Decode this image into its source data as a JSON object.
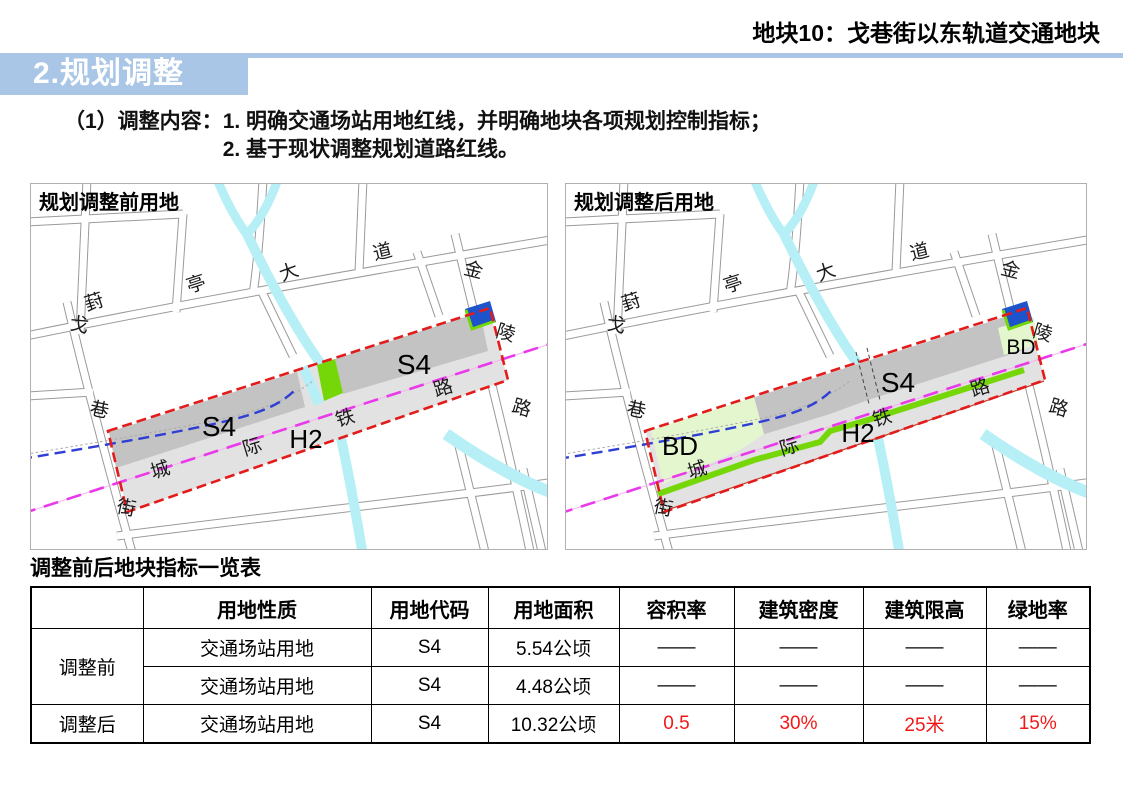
{
  "header": {
    "plot_tag": "地块10：戈巷街以东轨道交通地块"
  },
  "section": {
    "title": "2.规划调整"
  },
  "content": {
    "label": "（1）调整内容：",
    "items": [
      "1. 明确交通场站用地红线，并明确地块各项规划控制指标；",
      "2. 基于现状调整规划道路红线。"
    ]
  },
  "maps": {
    "before": {
      "title": "规划调整前用地",
      "s4_left": "S4",
      "s4_right": "S4",
      "h2": "H2"
    },
    "after": {
      "title": "规划调整后用地",
      "s4": "S4",
      "h2": "H2",
      "bd_left": "BD",
      "bd_right": "BD"
    },
    "streets": {
      "fengting": [
        "葑",
        "亭",
        "大",
        "道"
      ],
      "gexiang": [
        "戈",
        "巷",
        "街"
      ],
      "jinling": [
        "金",
        "陵",
        "路"
      ],
      "railway": [
        "城",
        "际",
        "铁",
        "路"
      ]
    }
  },
  "table": {
    "title": "调整前后地块指标一览表",
    "headers": [
      "",
      "用地性质",
      "用地代码",
      "用地面积",
      "容积率",
      "建筑密度",
      "建筑限高",
      "绿地率"
    ],
    "row_groups": [
      "调整前",
      "调整后"
    ],
    "rows": [
      {
        "cells": [
          "交通场站用地",
          "S4",
          "5.54公顷",
          "——",
          "——",
          "——",
          "——"
        ]
      },
      {
        "cells": [
          "交通场站用地",
          "S4",
          "4.48公顷",
          "——",
          "——",
          "——",
          "——"
        ]
      },
      {
        "cells": [
          "交通场站用地",
          "S4",
          "10.32公顷",
          "0.5",
          "30%",
          "25米",
          "15%"
        ]
      }
    ]
  },
  "colors": {
    "accent_bar": "#a9c6e6",
    "section_title_text": "#ffffff",
    "red_boundary": "#e31b1b",
    "railway_line": "#e93ae9",
    "metro_line": "#2f3fd4",
    "parcel_s4": "#c3c3c3",
    "parcel_h2": "#e2e2e2",
    "parcel_green": "#76d708",
    "parcel_bd": "#e4f6cd",
    "parcel_blue": "#1d53cb",
    "water": "#b6f0f6",
    "road_line": "#9a9a9a",
    "table_highlight_text": "#f21818"
  }
}
